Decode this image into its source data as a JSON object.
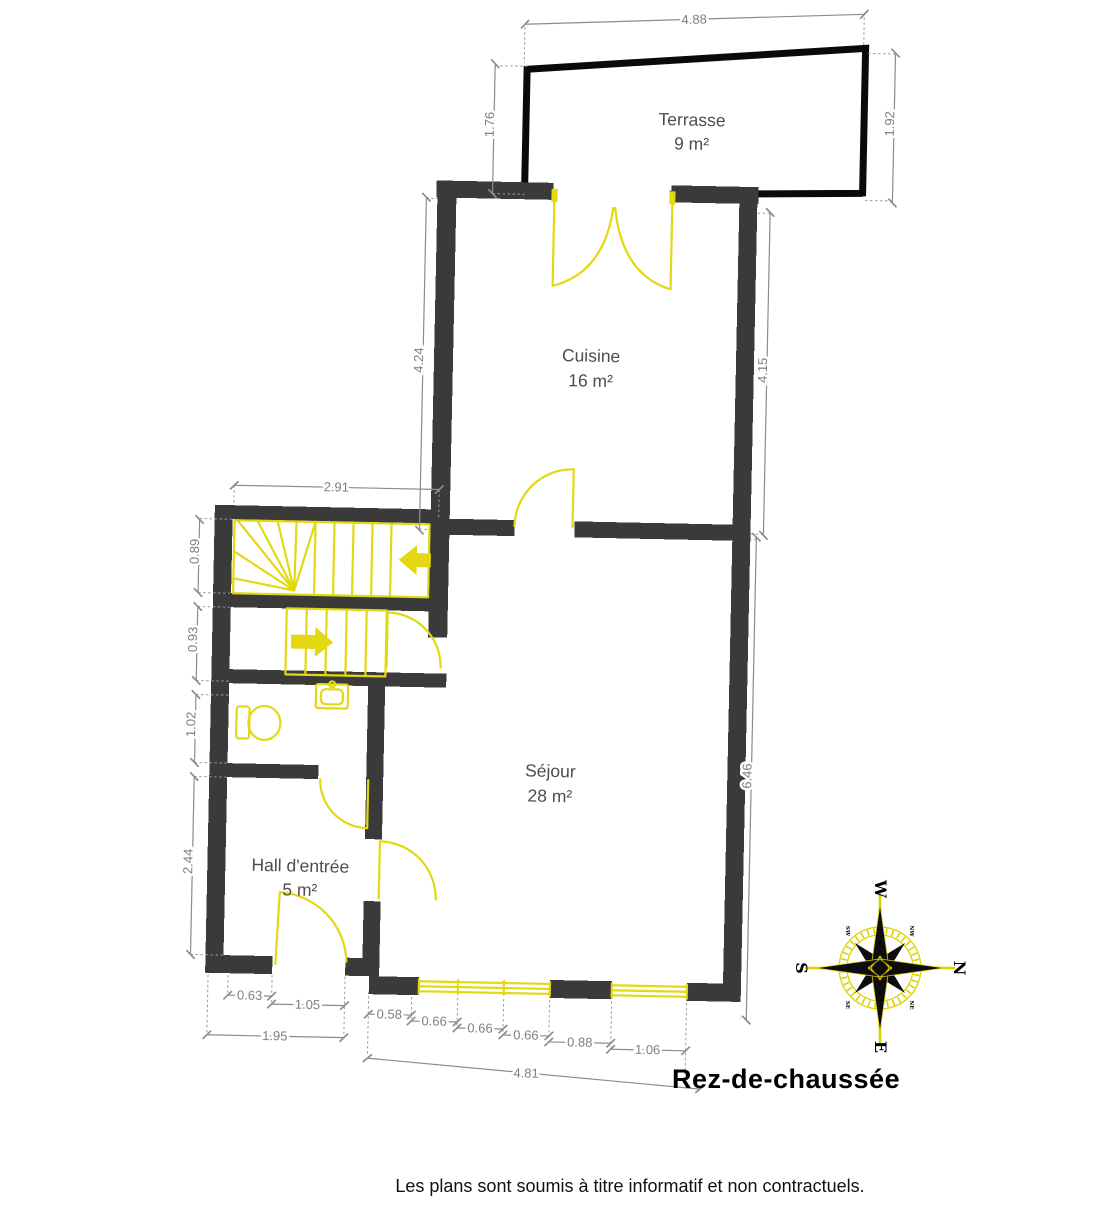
{
  "title": "Rez-de-chaussée",
  "disclaimer": "Les plans sont soumis à titre informatif et non contractuels.",
  "rooms": {
    "terrasse": {
      "name": "Terrasse",
      "area": "9 m²"
    },
    "cuisine": {
      "name": "Cuisine",
      "area": "16 m²"
    },
    "sejour": {
      "name": "Séjour",
      "area": "28 m²"
    },
    "hall": {
      "name": "Hall d'entrée",
      "area": "5 m²"
    }
  },
  "dims": {
    "terrace_width": "4.88",
    "terrace_h_left": "1.76",
    "terrace_h_right": "1.92",
    "cuisine_h_left": "4.24",
    "cuisine_h_right": "4.15",
    "stair_width": "2.91",
    "stair_upper_h": "0.89",
    "stair_lower_h": "0.93",
    "wc_h": "1.02",
    "hall_h": "2.44",
    "sejour_h": "6.46",
    "hall_bottom_wall": "0.63",
    "entry_door": "1.05",
    "hall_bottom_total": "1.95",
    "sejour_bottom_wall": "0.58",
    "window_pane_1": "0.66",
    "window_pane_2": "0.66",
    "window_pane_3": "0.66",
    "sejour_bottom_mid": "0.88",
    "window_right": "1.06",
    "sejour_bottom_total": "4.81"
  },
  "compass": {
    "n": "N",
    "e": "E",
    "s": "S",
    "w": "W",
    "ne": "NE",
    "nw": "NW",
    "se": "SE",
    "sw": "SW"
  },
  "colors": {
    "wall": "#3a3a3a",
    "terrace_outline": "#0a0a0a",
    "fixtures": "#e3d812",
    "dimensions": "#8c8c8c",
    "dim_text": "#7f7f7f",
    "room_label": "#4d4d4d"
  }
}
